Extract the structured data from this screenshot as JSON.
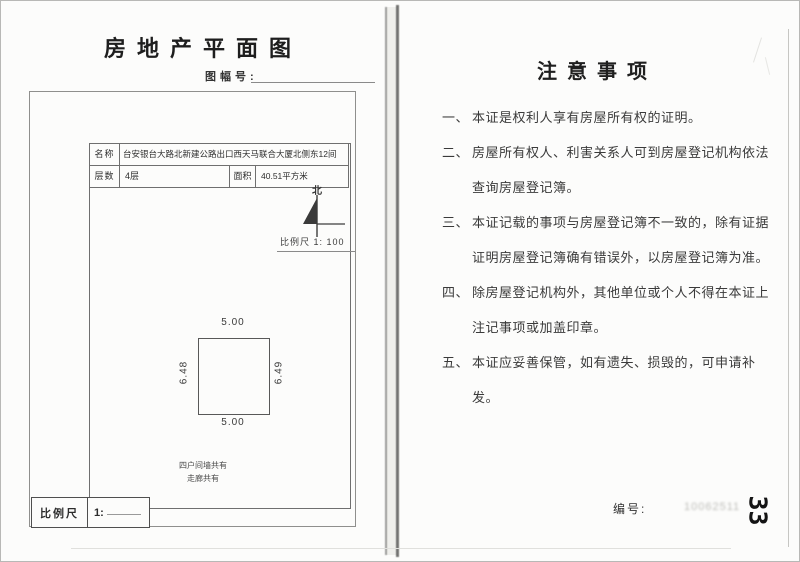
{
  "left_page": {
    "title": "房地产平面图",
    "sheet_no_label": "图幅号:",
    "table": {
      "name_label": "名称",
      "name_value": "台安银台大路北新建公路出口西天马联合大厦北侧东12间",
      "floors_label": "层数",
      "floors_value": "4层",
      "area_label": "面积",
      "area_value": "40.51平方米"
    },
    "compass": {
      "north_label": "北"
    },
    "scale_note": "比例尺 1: 100",
    "plan": {
      "dim_top": "5.00",
      "dim_bottom": "5.00",
      "dim_left": "6.48",
      "dim_right": "6.49",
      "note_line1": "四户间墙共有",
      "note_line2": "走廊共有"
    },
    "scale_box": {
      "label": "比例尺",
      "value": "1:"
    }
  },
  "right_page": {
    "title": "注意事项",
    "items": [
      {
        "num": "一、",
        "text": "本证是权利人享有房屋所有权的证明。"
      },
      {
        "num": "二、",
        "text": "房屋所有权人、利害关系人可到房屋登记机构依法查询房屋登记簿。"
      },
      {
        "num": "三、",
        "text": "本证记载的事项与房屋登记簿不一致的，除有证据证明房屋登记簿确有错误外，以房屋登记簿为准。"
      },
      {
        "num": "四、",
        "text": "除房屋登记机构外，其他单位或个人不得在本证上注记事项或加盖印章。"
      },
      {
        "num": "五、",
        "text": "本证应妥善保管，如有遗失、损毁的，可申请补发。"
      }
    ],
    "serial_label": "编号:",
    "serial_faint": "10062511",
    "page_number": "33"
  }
}
